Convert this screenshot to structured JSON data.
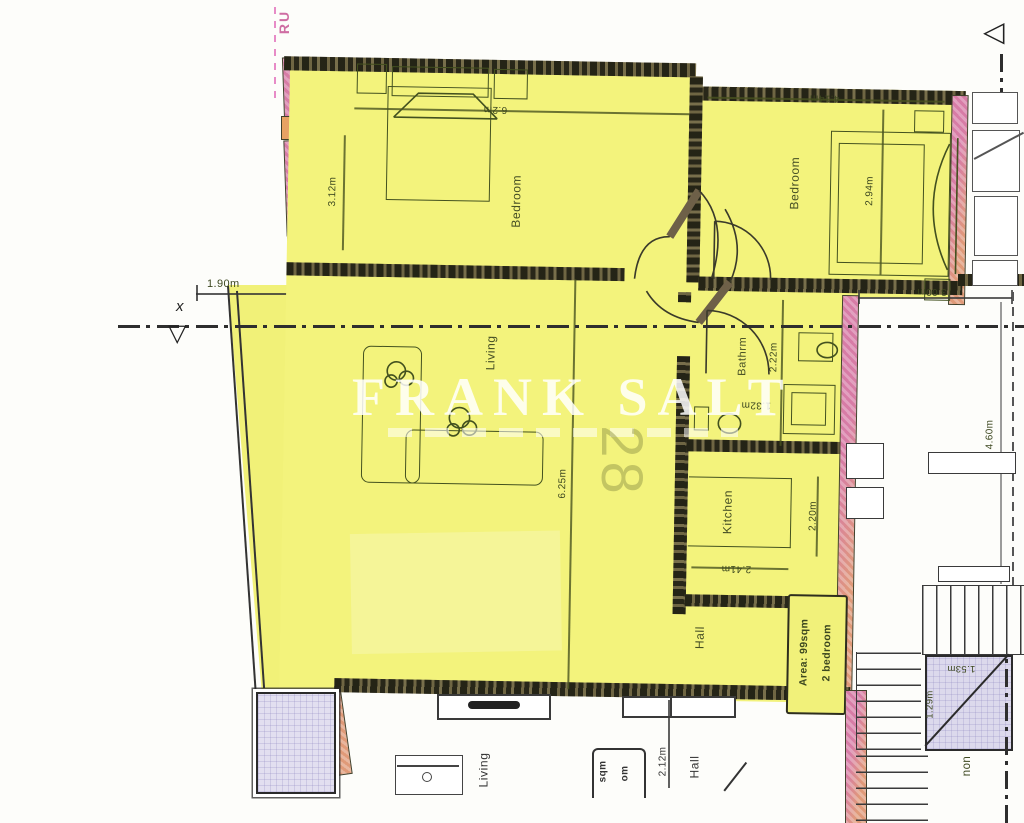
{
  "document_type": "scanned floor plan",
  "watermark": {
    "brand": "FRANK SALT"
  },
  "section": {
    "marker_x": "x",
    "corner_fragment": "RU"
  },
  "unit": {
    "number": "28",
    "area_line1": "Area: 99sqm",
    "area_line2": "2 bedroom"
  },
  "rooms": {
    "bedroom1": {
      "label": "Bedroom",
      "width": "6.2m",
      "depth": "3.12m"
    },
    "bedroom2": {
      "label": "Bedroom",
      "width": "4.14m",
      "depth": "2.94m"
    },
    "living": {
      "label": "Living",
      "depth": "6.25m"
    },
    "bathroom": {
      "label": "Bathrm",
      "depth": "2.22m",
      "width": "1.32m"
    },
    "kitchen": {
      "label": "Kitchen",
      "depth": "2.20m",
      "width": "2.41m"
    },
    "hall": {
      "label": "Hall"
    },
    "balcony": {
      "width": "1.90m"
    }
  },
  "stairwell": {
    "width": "3.00m",
    "depth": "4.60m",
    "lift_width": "1.53m",
    "lift_depth": "1.29m",
    "label_fragment": "non"
  },
  "lower_unit": {
    "living_label": "Living",
    "hall_label": "Hall",
    "dim": "2.12m",
    "area_fragment_1": "sqm",
    "area_fragment_2": "om"
  },
  "colors": {
    "highlight_yellow": "#f3f37c",
    "wall_dark": "#676040",
    "wall_pink": "#d77ca6",
    "wall_orange": "#e09a78",
    "line_olive": "#43511f",
    "shaft_fill": "#dcd9ec"
  }
}
